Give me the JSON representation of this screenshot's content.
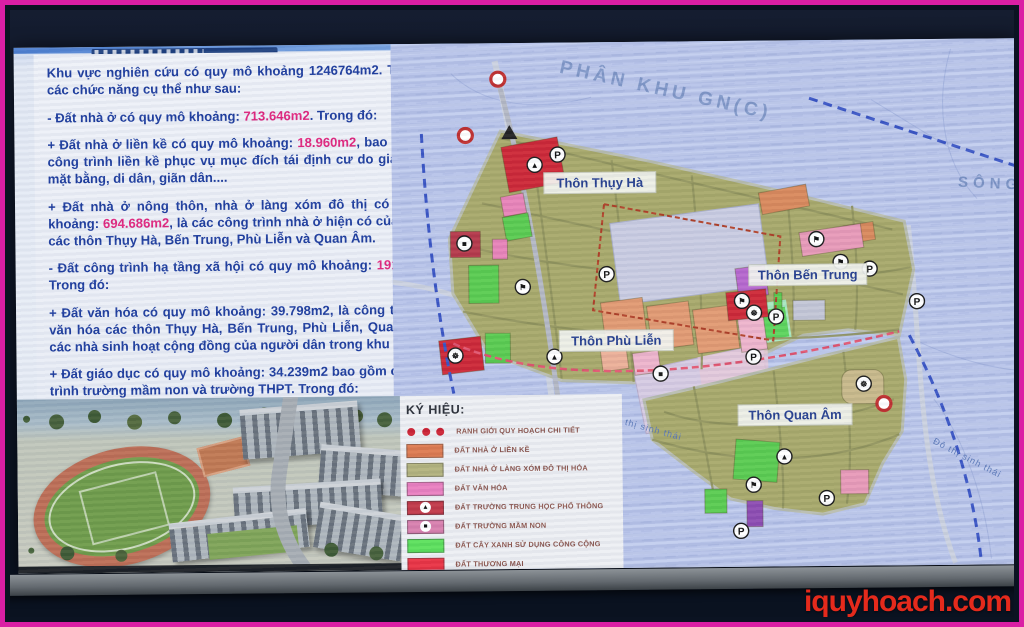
{
  "watermark": "iquyhoach.com",
  "slide": {
    "text_panel": {
      "paragraphs": [
        [
          {
            "t": "Khu vực nghiên cứu có quy mô khoảng 1246764m2. Trong đó các chức năng cụ thể như sau:",
            "h": false
          }
        ],
        [
          {
            "t": "- Đất nhà ở có quy mô khoảng: ",
            "h": false
          },
          {
            "t": "713.646m2",
            "h": true
          },
          {
            "t": ". Trong đó:",
            "h": false
          }
        ],
        [
          {
            "t": "+ Đất nhà ở liền kề có quy mô khoảng: ",
            "h": false
          },
          {
            "t": "18.960m2",
            "h": true
          },
          {
            "t": ", bao gồm các công trình liền kề phục vụ mục đích tái định cư do giải phóng mặt bằng, di dân, giãn dân....",
            "h": false
          }
        ],
        [
          {
            "t": "+ Đất nhà ở nông thôn, nhà ở làng xóm đô thị có quy mô khoảng: ",
            "h": false
          },
          {
            "t": "694.686m2",
            "h": true
          },
          {
            "t": ", là các công trình nhà ở hiện có của dân cư các thôn Thụy Hà, Bến Trung, Phù Liễn và Quan Âm.",
            "h": false
          }
        ],
        [
          {
            "t": "- Đất công trình hạ tầng xã hội có quy mô khoảng: ",
            "h": false
          },
          {
            "t": "191.336m2",
            "h": true
          },
          {
            "t": ". Trong đó:",
            "h": false
          }
        ],
        [
          {
            "t": "+ Đất văn hóa có quy mô khoảng: 39.798m2, là công trình nhà văn hóa các thôn Thụy Hà, Bến Trung, Phù Liễn, Quan Âm và các nhà sinh hoạt cộng đồng của người dân trong khu vực.",
            "h": false
          }
        ],
        [
          {
            "t": "+ Đất giáo dục có quy mô khoảng: 34.239m2 bao gồm các công trình trường mầm non và trường THPT. Trong đó:",
            "h": false
          }
        ],
        [
          {
            "t": "++ Đất trường THPT có quy mô khoảng: 20.485 m2.",
            "h": false
          }
        ],
        [
          {
            "t": "++ Đất trường mầm non có quy mô khoảng: 13.754 m2.",
            "h": false
          }
        ]
      ]
    },
    "map": {
      "zone_label": "PHÂN KHU GN(C)",
      "river_label": "SÔNG",
      "eco_labels": [
        "Đô thị sinh thái",
        "Đô thị sinh thái"
      ],
      "villages": [
        "Thôn Thụy Hà",
        "Thôn Bến Trung",
        "Thôn Phù Liễn",
        "Thôn Quan Âm"
      ],
      "icon_glyphs": {
        "parking": "P",
        "highschool": "▲",
        "kindergarten": "■",
        "culture": "⚑",
        "community": "☸"
      },
      "legend": {
        "title": "KÝ HIỆU:",
        "items": [
          {
            "type": "dots",
            "color": "#cc2233",
            "label": "RANH GIỚI QUY HOẠCH CHI TIẾT"
          },
          {
            "type": "swatch",
            "color": "#dd7a50",
            "label": "ĐẤT NHÀ Ở LIỀN KỀ"
          },
          {
            "type": "swatch",
            "color": "#b3b37e",
            "label": "ĐẤT NHÀ Ở LÀNG XÓM ĐÔ THỊ HÓA"
          },
          {
            "type": "swatch",
            "color": "#ea7fc0",
            "label": "ĐẤT VĂN HÓA"
          },
          {
            "type": "swatch",
            "color": "#c13848",
            "icon": "triangle",
            "label": "ĐẤT TRƯỜNG TRUNG HỌC PHỔ THÔNG"
          },
          {
            "type": "swatch",
            "color": "#d87fae",
            "icon": "square",
            "label": "ĐẤT TRƯỜNG MẦM NON"
          },
          {
            "type": "swatch",
            "color": "#5ce05c",
            "label": "ĐẤT CÂY XANH SỬ DỤNG CÔNG CỘNG"
          },
          {
            "type": "swatch",
            "color": "#ea3344",
            "label": "ĐẤT THƯƠNG MẠI"
          }
        ]
      }
    }
  },
  "colors": {
    "frame_border": "#da1fa4",
    "text_blue": "#1e3d9e",
    "highlight_pink": "#e0267e",
    "water_blue": "#b7c3e9",
    "land_olive": "#a8a96a",
    "watermark_red": "#e52a1c"
  }
}
